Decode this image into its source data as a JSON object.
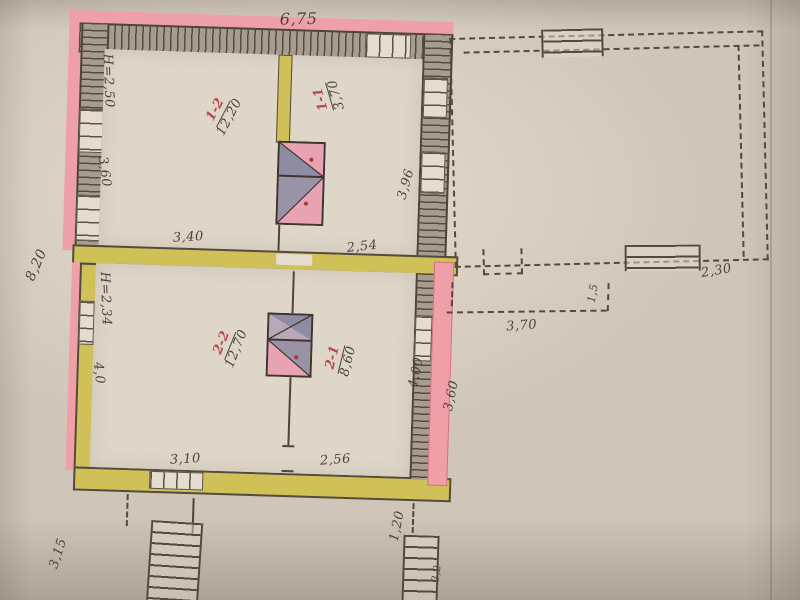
{
  "document_type": "hand-drawn floor plan photo",
  "colors": {
    "paper": "#cfc5b9",
    "wall_highlight_pink": "#ef9fa7",
    "wall_highlight_yellow": "#cfc157",
    "ink": "#4e443c",
    "room_number_red": "#b5494e"
  },
  "dims": {
    "top": "6,75",
    "left": "8,20",
    "r12_h": "H=2,50",
    "r12_w": "3,60",
    "r12_bottom": "3,40",
    "r11_bottom": "2,54",
    "r11_right": "3,96",
    "r22_h": "H=2,34",
    "r22_w": "4,0",
    "r22_bottom": "3,10",
    "r21_bottom": "2,56",
    "r21_right": "4,00",
    "r21_outer": "3,60",
    "annex_width": "2,30",
    "path_len": "3,70",
    "path_w": "1,5",
    "steps_left": "3,15",
    "steps_right": "1,20",
    "steps_right_side": "3,2"
  },
  "rooms": [
    {
      "number": "1-2",
      "area": "12,20"
    },
    {
      "number": "1-1",
      "area": "3,70"
    },
    {
      "number": "2-2",
      "area": "12,70"
    },
    {
      "number": "2-1",
      "area": "8,60"
    }
  ]
}
